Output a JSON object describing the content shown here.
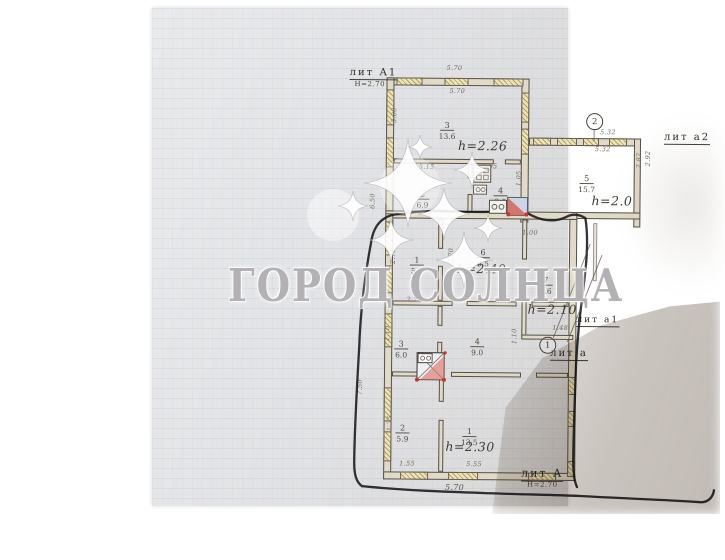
{
  "watermark": {
    "text": "ГОРОД СОЛНЦА"
  },
  "plan": {
    "labels": {
      "litA1": "лит А1",
      "litA1_note": "Н=2.70",
      "lita2": "лит а2",
      "lita1": "лит а1",
      "lita": "лит а",
      "litA": "лит А",
      "litA_note": "Н=2.70",
      "marker1": "1",
      "marker2": "2"
    },
    "heights": [
      "h=2.26",
      "h=2.0",
      "h=2.40",
      "h=2.10",
      "h=2.30"
    ],
    "rooms": [
      {
        "num": "3",
        "area": "13.6"
      },
      {
        "num": "2",
        "area": "6.9"
      },
      {
        "num": "4",
        "area": "3.9"
      },
      {
        "num": "5",
        "area": "15.7"
      },
      {
        "num": "1",
        "area": "5.7"
      },
      {
        "num": "6",
        "area": "8.5"
      },
      {
        "num": "7",
        "area": "4.6"
      },
      {
        "num": "3",
        "area": "6.0"
      },
      {
        "num": "4",
        "area": "9.0"
      },
      {
        "num": "2",
        "area": "5.9"
      },
      {
        "num": "1",
        "area": "13.5"
      }
    ],
    "dims": [
      "5.70",
      "5.70",
      "3.00",
      "5.15",
      "1.95",
      "2.20",
      "6.50",
      "2.70",
      "2.70",
      "2.20",
      "2.9",
      "1.00",
      "1.05",
      "1.48",
      "5.32",
      "5.32",
      "2.82",
      "2.92",
      "1.10",
      "1.10",
      "1.35",
      "7.50",
      "1.55",
      "5.55",
      "5.70"
    ],
    "colors": {
      "paper": "#e2e3e5",
      "wall_line": "#55514a",
      "window_fill": "#ece4b6",
      "red_mark": "#c2453a",
      "shadow": "#5e4c3c"
    }
  }
}
